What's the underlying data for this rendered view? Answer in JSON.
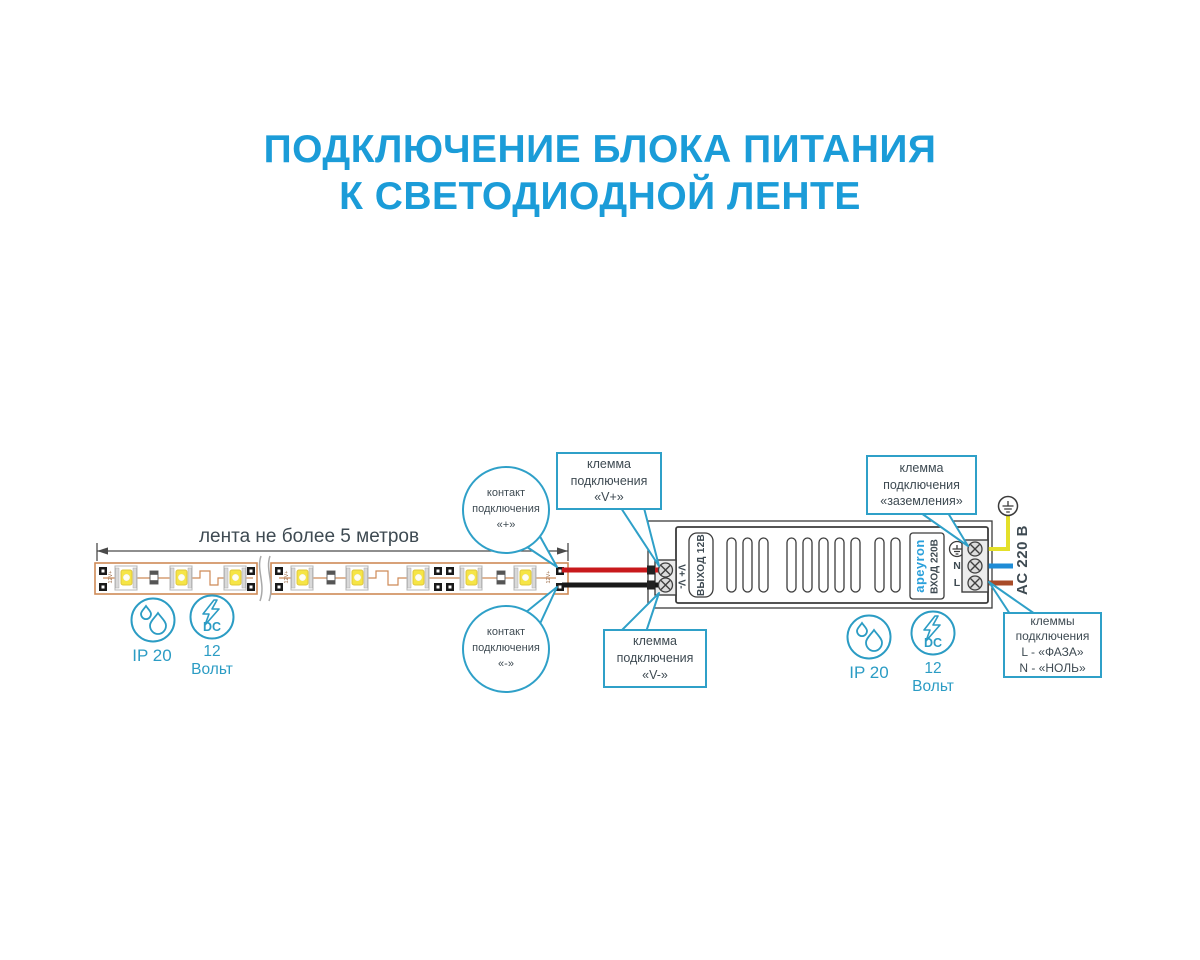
{
  "title": {
    "line1": "ПОДКЛЮЧЕНИЕ БЛОКА ПИТАНИЯ",
    "line2": "К СВЕТОДИОДНОЙ ЛЕНТЕ"
  },
  "strip": {
    "dimension_label": "лента не более 5 метров",
    "pad_marking": "12V+"
  },
  "callouts": {
    "contact_plus": "контакт подключения «+»",
    "contact_minus": "контакт подключения «-»",
    "terminal_v_plus": "клемма подключения «V+»",
    "terminal_v_minus": "клемма подключения «V-»",
    "terminal_ground": "клемма подключения «заземления»",
    "terminal_ln": {
      "lines": [
        "клеммы",
        "подключения",
        "L - «ФАЗА»",
        "N - «НОЛЬ»"
      ]
    }
  },
  "psu": {
    "output_terminals": "V+ V-",
    "output_label": "ВЫХОД 12В",
    "brand": "apeyron",
    "input_label": "ВХОД 220В",
    "neutral": "N",
    "line": "L",
    "ac_label": "AC 220 В"
  },
  "badges": {
    "ip": "IP 20",
    "dc": "DC",
    "voltage": "12",
    "voltage_unit": "Вольт"
  },
  "colors": {
    "title": "#1B9CD8",
    "callout": "#2FA0C8",
    "label": "#3E4A52",
    "strip_outline": "#CE8A57",
    "wire_red": "#C8191C",
    "wire_black": "#191919",
    "wire_ground_yellow": "#E4E02A",
    "wire_neutral_blue": "#1F8CD6",
    "wire_line_brown": "#A84B28",
    "brand_blue": "#2AA0DB",
    "led_yellow": "#F6E545"
  }
}
